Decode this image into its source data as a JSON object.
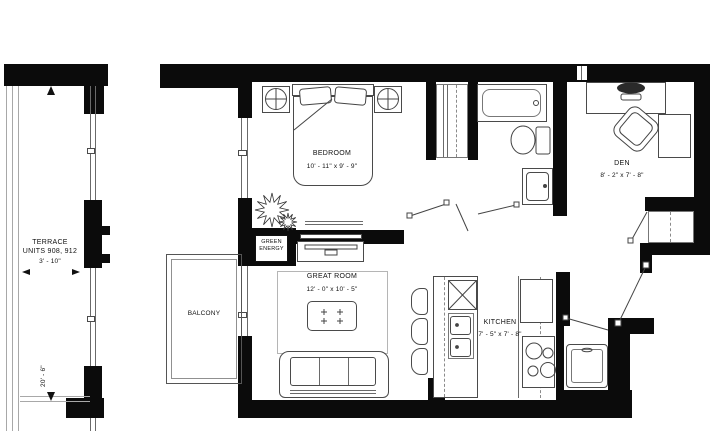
{
  "plan": {
    "title": "Floor plan — 1 bedroom + den suite",
    "rooms": {
      "terrace": {
        "name": "TERRACE",
        "units": "UNITS 908, 912",
        "width_dim": "3' - 10\"",
        "depth_dim": "20' - 6\""
      },
      "balcony": {
        "name": "BALCONY"
      },
      "bedroom": {
        "name": "BEDROOM",
        "dims": "10' - 11\" x 9' - 9\""
      },
      "great_room": {
        "name": "GREAT ROOM",
        "dims": "12' - 0\" x 10' - 5\""
      },
      "kitchen": {
        "name": "KITCHEN",
        "dims": "7' - 5\" x 7' - 8\""
      },
      "den": {
        "name": "DEN",
        "dims": "8' - 2\" x 7' - 8\""
      }
    },
    "labels": {
      "green_energy_line1": "GREEN",
      "green_energy_line2": "ENERGY"
    },
    "colors": {
      "wall": "#0b0b0b",
      "furniture_line": "#4a4a4a",
      "light_line": "#a8a8a8",
      "background": "#ffffff",
      "text": "#111111"
    }
  }
}
